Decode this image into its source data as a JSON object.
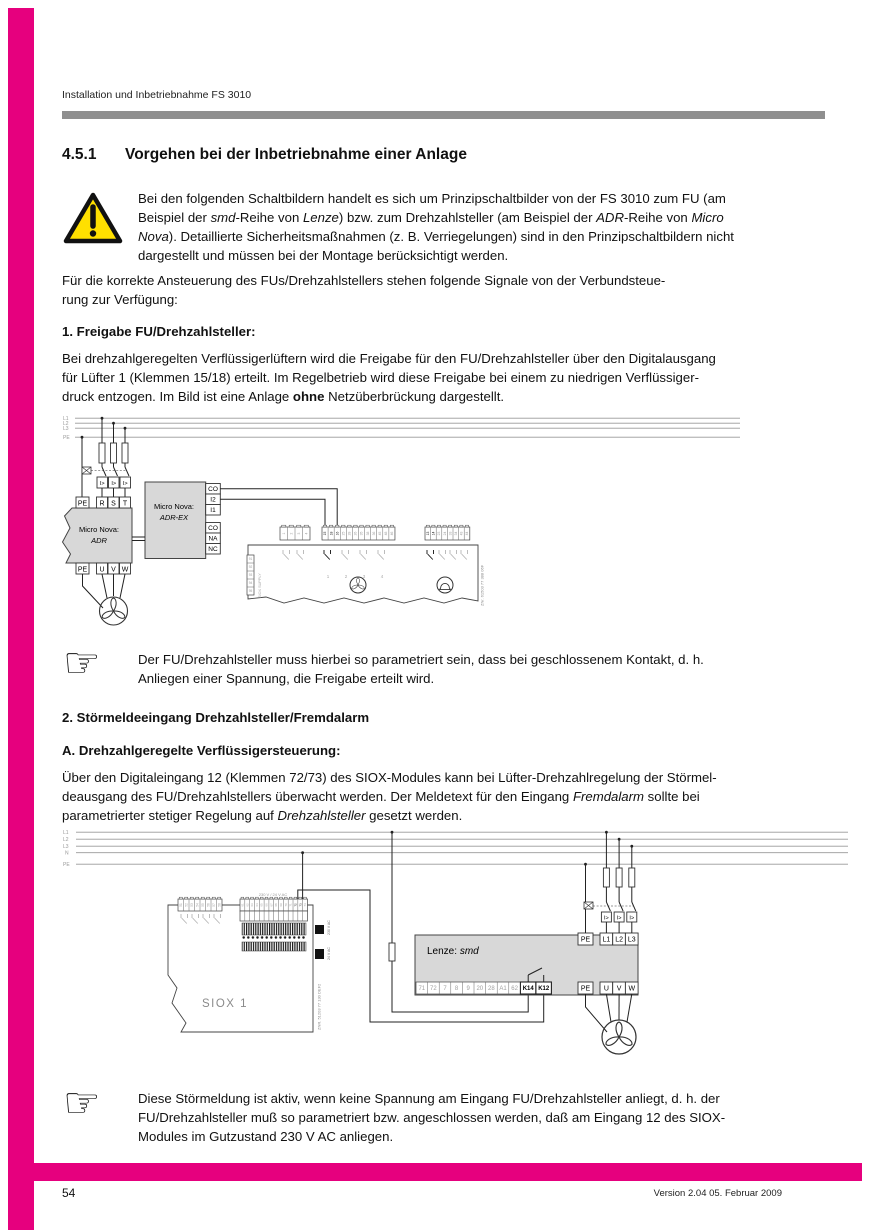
{
  "page": {
    "header": "Installation und Inbetriebnahme FS 3010",
    "page_number": "54",
    "version": "Version 2.04   05. Februar 2009",
    "accent_color": "#e6007e"
  },
  "title": {
    "number": "4.5.1",
    "text": "Vorgehen bei der Inbetriebnahme einer Anlage"
  },
  "warning": {
    "l1": "Bei den folgenden Schaltbildern handelt es sich um Prinzipschaltbilder von der FS 3010 zum FU (am",
    "l2a": "Beispiel der ",
    "l2b": "smd",
    "l2c": "-Reihe von ",
    "l2d": "Lenze",
    "l2e": ") bzw. zum Drehzahlsteller (am Beispiel der ",
    "l2f": "ADR",
    "l2g": "-Reihe von ",
    "l2h": "Micro",
    "l3a": "Nova",
    "l3b": "). Detaillierte Sicherheitsmaßnahmen (z. B. Verriegelungen) sind in den Prinzipschaltbildern nicht",
    "l4": "dargestellt und müssen bei der Montage berücksichtigt werden."
  },
  "intro": {
    "l1": "Für die korrekte Ansteuerung des FUs/Drehzahlstellers stehen folgende Signale von der Verbundsteue-",
    "l2": "rung zur Verfügung:"
  },
  "sec1": {
    "heading": "1. Freigabe FU/Drehzahlsteller:",
    "l1": "Bei drehzahlgeregelten Verflüssigerlüftern wird die Freigabe für den FU/Drehzahlsteller über den Digitalausgang",
    "l2": "für Lüfter 1 (Klemmen 15/18) erteilt. Im Regelbetrieb wird diese Freigabe bei einem zu niedrigen Verflüssiger-",
    "l3a": "druck entzogen. Im Bild ist eine Anlage ",
    "l3b": "ohne",
    "l3c": " Netzüberbrückung dargestellt."
  },
  "note1": {
    "l1": "Der FU/Drehzahlsteller muss hierbei so parametriert sein, dass bei geschlossenem Kontakt, d. h.",
    "l2": "Anliegen einer Spannung, die Freigabe erteilt wird."
  },
  "sec2": {
    "heading": "2. Störmeldeeingang Drehzahlsteller/Fremdalarm",
    "subheading": "A. Drehzahlgeregelte Verflüssigersteuerung:",
    "l1": "Über den Digitaleingang 12 (Klemmen 72/73) des SIOX-Modules kann bei Lüfter-Drehzahlregelung der Störmel-",
    "l2a": "deausgang des FU/Drehzahlstellers überwacht werden. Der Meldetext für den Eingang ",
    "l2b": "Fremdalarm",
    "l2c": " sollte bei",
    "l3a": "parametrierter stetiger Regelung auf ",
    "l3b": "Drehzahlsteller",
    "l3c": " gesetzt werden."
  },
  "note2": {
    "l1": "Diese Störmeldung ist aktiv, wenn keine Spannung am Eingang FU/Drehzahlsteller anliegt, d. h. der",
    "l2": "FU/Drehzahlsteller muß so parametriert bzw. angeschlossen werden, daß am Eingang 12 des SIOX-",
    "l3": "Modules im Gutzustand 230 V AC anliegen."
  },
  "diagram1": {
    "rails": [
      "L1",
      "L2",
      "L3",
      "PE"
    ],
    "breaker_label": "I>",
    "adr": {
      "line1": "Micro Nova:",
      "line2": "ADR",
      "top_terminals": [
        "PE",
        "R",
        "S",
        "T"
      ],
      "bottom_terminals": [
        "PE",
        "U",
        "V",
        "W"
      ]
    },
    "adrex": {
      "line1": "Micro Nova:",
      "line2": "ADR-EX",
      "terminals_top": [
        "CO",
        "I2",
        "I1"
      ],
      "terminals_bottom": [
        "CO",
        "NA",
        "NC"
      ]
    },
    "strip_a": [
      "1",
      "2",
      "3",
      "4"
    ],
    "strip_b": [
      "15",
      "18",
      "16",
      "25",
      "28",
      "26",
      "35",
      "38",
      "36",
      "45",
      "48",
      "46"
    ],
    "strip_c": [
      "13",
      "14",
      "23",
      "24",
      "33",
      "34",
      "43",
      "44"
    ],
    "group_numbers": [
      "1",
      "2",
      "3",
      "4"
    ],
    "supply": {
      "terminals": [
        "91",
        "92",
        "93",
        "94",
        "95"
      ],
      "label": "SIOX SUPPLY"
    },
    "part_number": "ZNr. 61503 77 388 06F"
  },
  "diagram2": {
    "rails": [
      "L1",
      "L2",
      "L3",
      "N",
      "PE"
    ],
    "breaker_label": "I>",
    "siox": {
      "label": "SIOX 1",
      "strip_left": [
        "51",
        "52",
        "53",
        "54",
        "55",
        "56",
        "57",
        "58"
      ],
      "strip_right": [
        "61",
        "62",
        "63",
        "64",
        "65",
        "66",
        "67",
        "68",
        "69",
        "70",
        "71",
        "72",
        "73",
        "74"
      ],
      "voltage_label": "230 V / 24 V AC",
      "block_230": "230 V AC",
      "block_24": "24 V AC",
      "part_number": "ZNR. 51203 77 130 DEF2"
    },
    "lenze": {
      "label_a": "Lenze: ",
      "label_b": "smd",
      "control_terminals": [
        "71",
        "72",
        "7",
        "8",
        "9",
        "20",
        "28",
        "A1",
        "62"
      ],
      "relay_terminals": [
        "K14",
        "K12"
      ],
      "pe_top": "PE",
      "mains_terminals": [
        "L1",
        "L2",
        "L3"
      ],
      "pe_bottom": "PE",
      "motor_terminals": [
        "U",
        "V",
        "W"
      ]
    }
  }
}
